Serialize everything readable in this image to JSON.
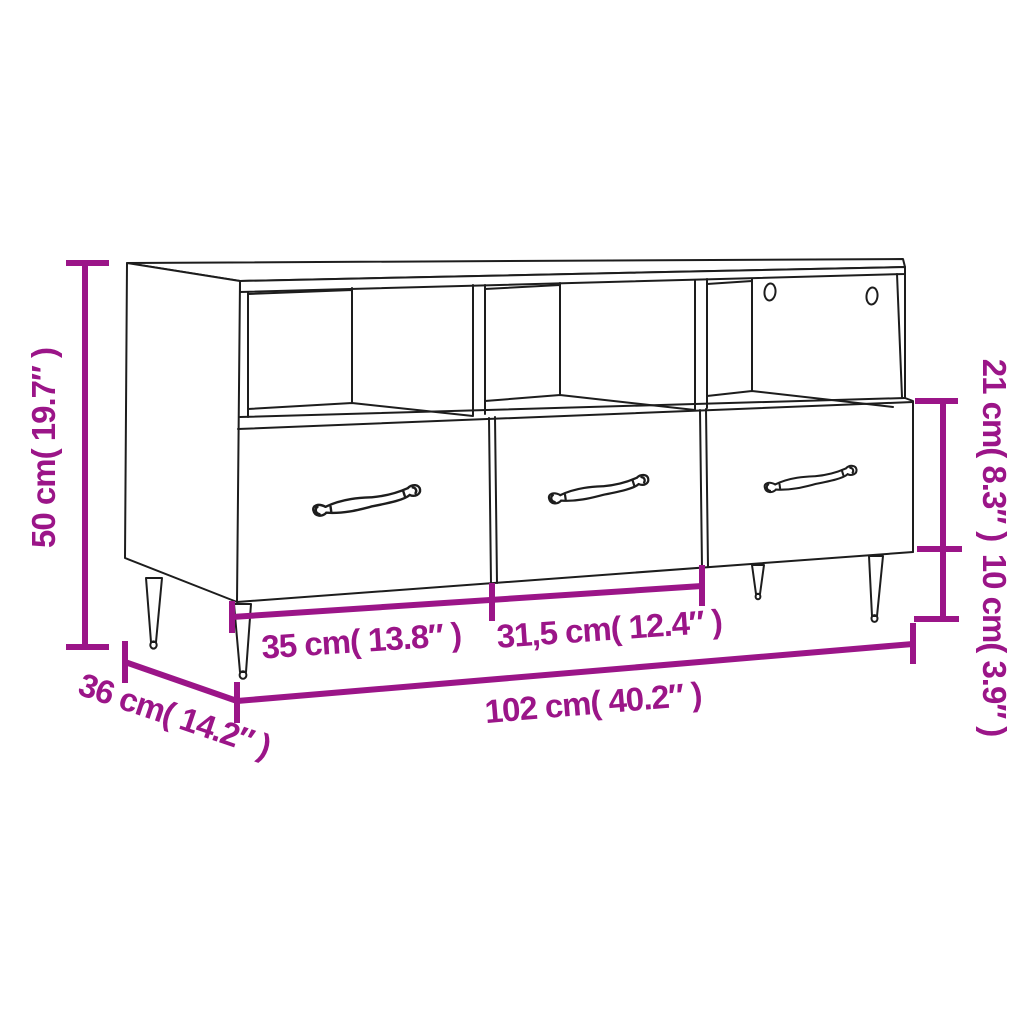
{
  "diagram": {
    "type": "product-dimension-diagram",
    "product": "TV cabinet line drawing with three open compartments, three drawers with ornate handles, two cable holes and tapered legs",
    "background": "#ffffff",
    "line_color": "#1d1d1d",
    "accent_color": "#9B1588",
    "labels": {
      "height": "50 cm( 19.7″ )",
      "compartment_height": "21 cm( 8.3″ )",
      "leg_height": "10 cm( 3.9″ )",
      "drawer_left_width": "35 cm( 13.8″ )",
      "drawer_middle_width": "31,5 cm( 12.4″ )",
      "total_width": "102 cm( 40.2″ )",
      "depth": "36 cm( 14.2″ )"
    }
  }
}
